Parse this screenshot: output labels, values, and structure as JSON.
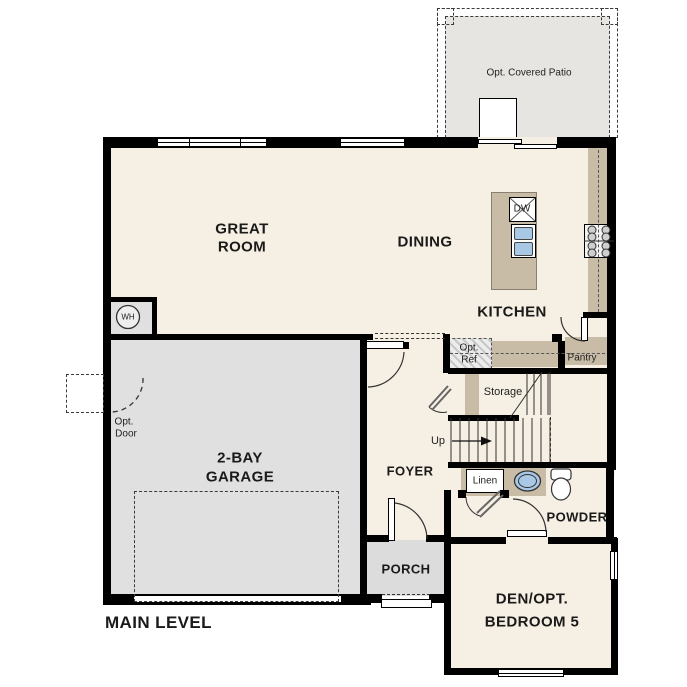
{
  "title": "MAIN LEVEL",
  "labels": {
    "patio": "Opt. Covered Patio",
    "great_1": "GREAT",
    "great_2": "ROOM",
    "dining": "DINING",
    "kitchen": "KITCHEN",
    "dw": "DW",
    "wh": "WH",
    "opt_ref_1": "Opt.",
    "opt_ref_2": "Ref",
    "pantry": "Pantry",
    "storage": "Storage",
    "up": "Up",
    "linen": "Linen",
    "foyer": "FOYER",
    "powder": "POWDER",
    "porch": "PORCH",
    "garage_1": "2-BAY",
    "garage_2": "GARAGE",
    "opt_door_1": "Opt.",
    "opt_door_2": "Door",
    "den_1": "DEN/OPT.",
    "den_2": "BEDROOM 5",
    "main_level": "MAIN LEVEL"
  },
  "colors": {
    "floor": "#f6efe3",
    "garage_floor": "#e0e0e0",
    "porch_floor": "#dcdcdc",
    "patio_floor": "#e6e5e2",
    "counter": "#c9bca6",
    "sink_blue": "#a9c8e6",
    "wall": "#000000"
  }
}
